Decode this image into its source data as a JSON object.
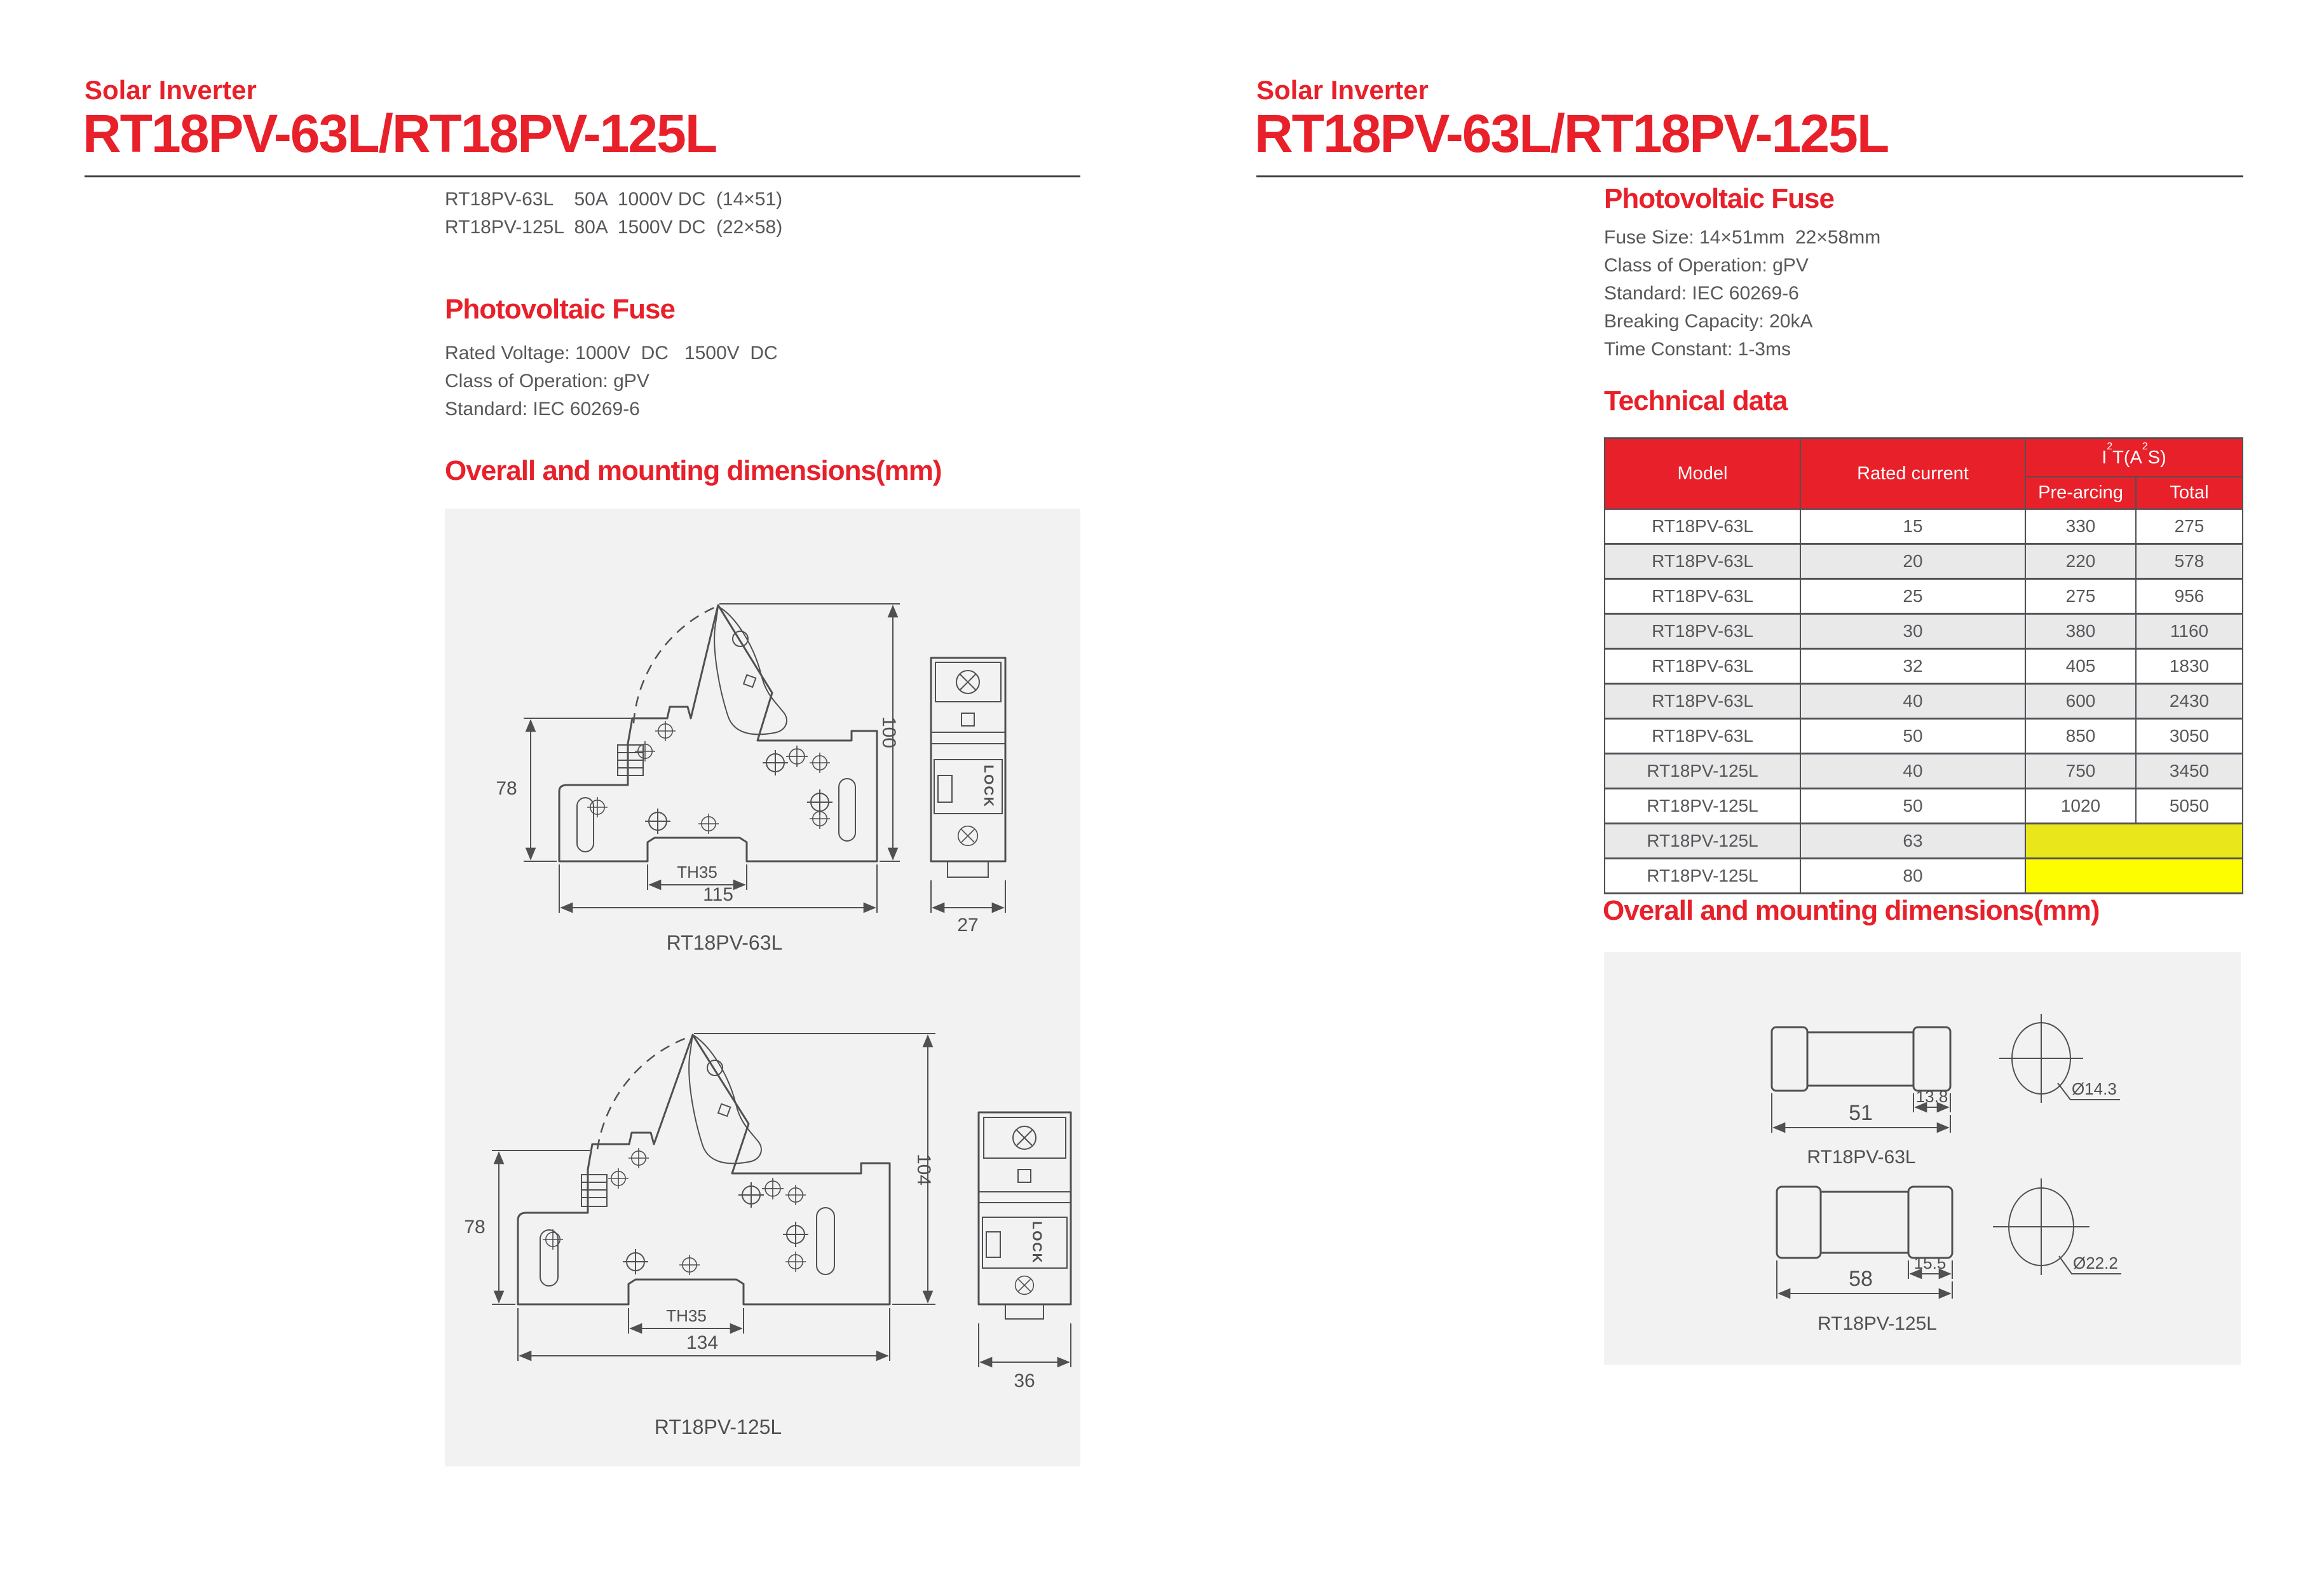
{
  "colors": {
    "accent_red": "#e8202a",
    "body_text": "#57585b",
    "drawing_line": "#4f5052",
    "panel_gray": "#f2f2f3",
    "row_alt_gray": "#e9e9ea",
    "highlight_yellow_dark": "#eae61c",
    "highlight_yellow_bright": "#fdfd00"
  },
  "left_page": {
    "eyebrow": "Solar Inverter",
    "title": "RT18PV-63L/RT18PV-125L",
    "product_lines": [
      "RT18PV-63L    50A  1000V DC  (14×51)",
      "RT18PV-125L  80A  1500V DC  (22×58)"
    ],
    "fuse_section": {
      "heading": "Photovoltaic Fuse",
      "lines": [
        "Rated Voltage: 1000V  DC   1500V  DC",
        "Class of Operation: gPV",
        "Standard: IEC 60269-6"
      ]
    },
    "dims_heading": "Overall and mounting dimensions(mm)",
    "drawing_63l": {
      "label": "RT18PV-63L",
      "dim_left_height": "78",
      "dim_right_height": "100",
      "dim_rail": "TH35",
      "dim_width": "115",
      "dim_depth": "27",
      "lock_label": "LOCK"
    },
    "drawing_125l": {
      "label": "RT18PV-125L",
      "dim_left_height": "78",
      "dim_right_height": "104",
      "dim_rail": "TH35",
      "dim_width": "134",
      "dim_depth": "36",
      "lock_label": "LOCK"
    }
  },
  "right_page": {
    "eyebrow": "Solar Inverter",
    "title": "RT18PV-63L/RT18PV-125L",
    "fuse_section": {
      "heading": "Photovoltaic Fuse",
      "lines": [
        "Fuse Size: 14×51mm  22×58mm",
        "Class of Operation: gPV",
        "Standard: IEC 60269-6",
        "Breaking Capacity: 20kA",
        "Time Constant: 1-3ms"
      ]
    },
    "table_heading": "Technical data",
    "table": {
      "headers": {
        "model": "Model",
        "rated_current": "Rated current",
        "i2t_prefix": "I",
        "i2t_sup1": "2",
        "i2t_mid": "T(A",
        "i2t_sup2": "2",
        "i2t_suffix": "S)",
        "pre_arcing": "Pre-arcing",
        "total": "Total"
      },
      "rows": [
        {
          "model": "RT18PV-63L",
          "rated_current": "15",
          "pre_arcing": "330",
          "total": "275"
        },
        {
          "model": "RT18PV-63L",
          "rated_current": "20",
          "pre_arcing": "220",
          "total": "578"
        },
        {
          "model": "RT18PV-63L",
          "rated_current": "25",
          "pre_arcing": "275",
          "total": "956"
        },
        {
          "model": "RT18PV-63L",
          "rated_current": "30",
          "pre_arcing": "380",
          "total": "1160"
        },
        {
          "model": "RT18PV-63L",
          "rated_current": "32",
          "pre_arcing": "405",
          "total": "1830"
        },
        {
          "model": "RT18PV-63L",
          "rated_current": "40",
          "pre_arcing": "600",
          "total": "2430"
        },
        {
          "model": "RT18PV-63L",
          "rated_current": "50",
          "pre_arcing": "850",
          "total": "3050"
        },
        {
          "model": "RT18PV-125L",
          "rated_current": "40",
          "pre_arcing": "750",
          "total": "3450"
        },
        {
          "model": "RT18PV-125L",
          "rated_current": "50",
          "pre_arcing": "1020",
          "total": "5050"
        },
        {
          "model": "RT18PV-125L",
          "rated_current": "63",
          "pre_arcing": "",
          "total": "",
          "highlight": "yellow-dark"
        },
        {
          "model": "RT18PV-125L",
          "rated_current": "80",
          "pre_arcing": "",
          "total": "",
          "highlight": "yellow-bright"
        }
      ]
    },
    "dims_heading": "Overall and mounting dimensions(mm)",
    "fuse_63l": {
      "label": "RT18PV-63L",
      "dim_length": "51",
      "dim_cap": "13.8",
      "dim_diameter": "Ø14.3"
    },
    "fuse_125l": {
      "label": "RT18PV-125L",
      "dim_length": "58",
      "dim_cap": "15.5",
      "dim_diameter": "Ø22.2"
    }
  }
}
